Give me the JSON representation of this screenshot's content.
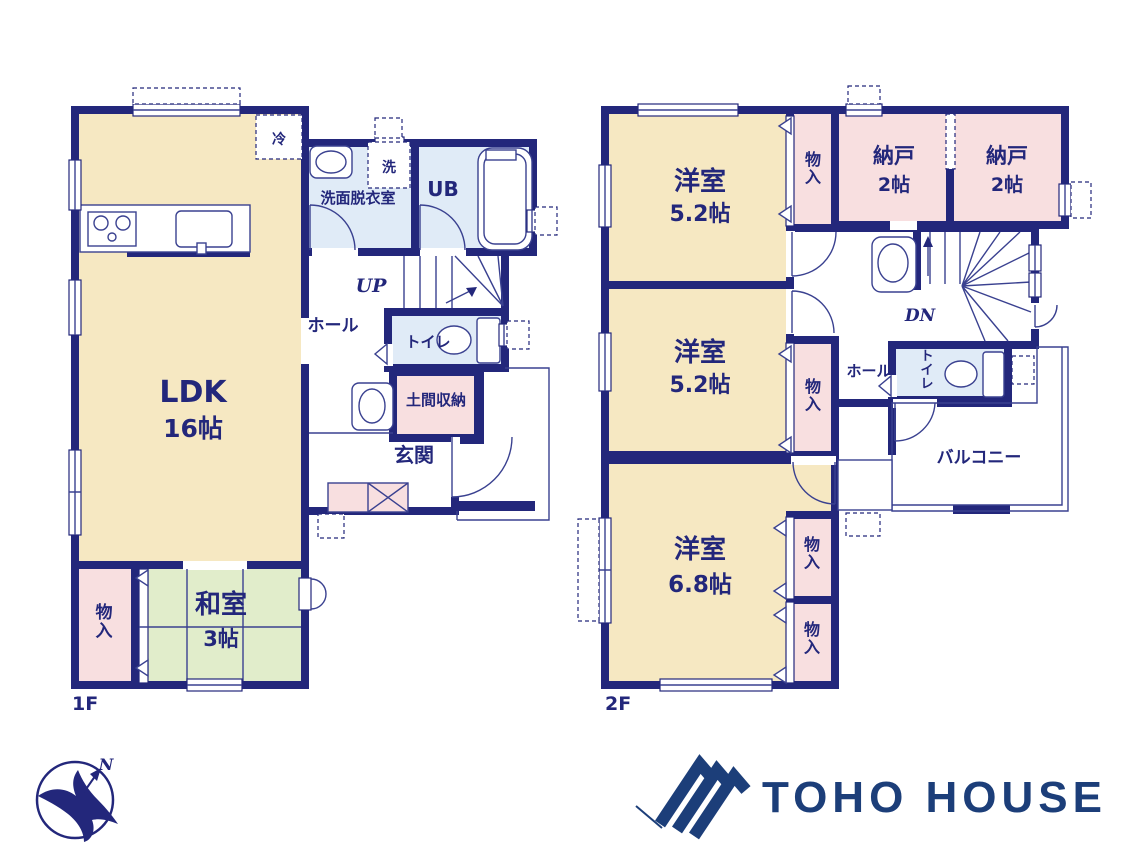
{
  "floor1": {
    "label": "1F",
    "ldk": {
      "name": "LDK",
      "size": "16帖"
    },
    "washitsu": {
      "name": "和室",
      "size": "3帖"
    },
    "closet": "物入",
    "washroom": "洗面脱衣室",
    "bath": "UB",
    "laundry": "洗",
    "fridge": "冷",
    "hall": "ホール",
    "toilet": "トイレ",
    "stairs": "UP",
    "doma": "土間収納",
    "entrance": "玄関"
  },
  "floor2": {
    "label": "2F",
    "room1": {
      "name": "洋室",
      "size": "5.2帖"
    },
    "room2": {
      "name": "洋室",
      "size": "5.2帖"
    },
    "room3": {
      "name": "洋室",
      "size": "6.8帖"
    },
    "storage1": {
      "name": "納戸",
      "size": "2帖"
    },
    "storage2": {
      "name": "納戸",
      "size": "2帖"
    },
    "closet_top": "物入",
    "closet_mid": "物入",
    "closet_b1": "物入",
    "closet_b2": "物入",
    "hall": "ホール",
    "toilet": "トイレ",
    "stairs": "DN",
    "balcony": "バルコニー"
  },
  "branding": {
    "company": "TOHO HOUSE",
    "compass_north": "N"
  },
  "colors": {
    "wall_navy": "#23277b",
    "room_beige": "#f6e8c2",
    "tatami_green": "#e1edcb",
    "closet_pink": "#f8dfe0",
    "wet_area_blue": "#e0ebf7",
    "logo_navy": "#1c3e79"
  }
}
